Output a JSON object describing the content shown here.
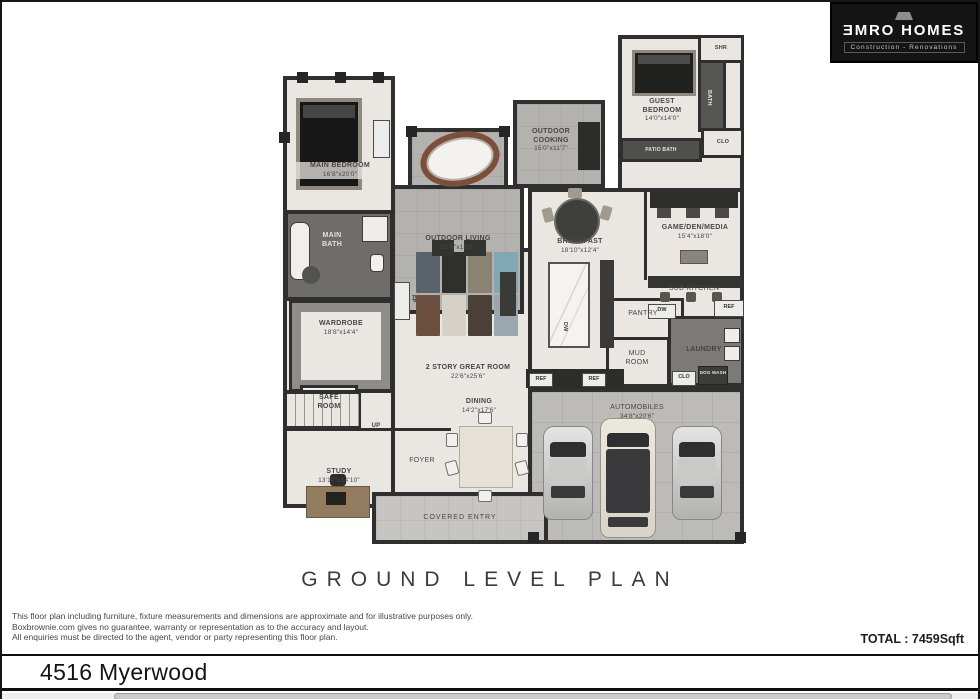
{
  "logo": {
    "brand": "ƎMRO HOMES",
    "tagline": "Construction - Renovations"
  },
  "plan": {
    "title": "GROUND LEVEL PLAN",
    "rooms": [
      {
        "name": "MAIN BEDROOM",
        "dims": "16'8\"x20'0\""
      },
      {
        "name": "OUTDOOR LIVING",
        "dims": "21'6\"x15'0\""
      },
      {
        "name": "OUTDOOR COOKING",
        "dims": "15'0\"x11'7\""
      },
      {
        "name": "GUEST BEDROOM",
        "dims": "14'0\"x14'0\""
      },
      {
        "name": "BREAKFAST",
        "dims": "18'10\"x12'4\""
      },
      {
        "name": "GAME/DEN/MEDIA",
        "dims": "15'4\"x18'0\""
      },
      {
        "name": "MAIN BATH",
        "dims": ""
      },
      {
        "name": "WARDROBE",
        "dims": "18'8\"x14'4\""
      },
      {
        "name": "2 STORY GREAT ROOM",
        "dims": "22'6\"x25'6\""
      },
      {
        "name": "SUB KITCHEN",
        "dims": ""
      },
      {
        "name": "PANTRY",
        "dims": ""
      },
      {
        "name": "MUD ROOM",
        "dims": ""
      },
      {
        "name": "LAUNDRY",
        "dims": ""
      },
      {
        "name": "SAFE ROOM",
        "dims": ""
      },
      {
        "name": "STUDY",
        "dims": "13'10\"x14'10\""
      },
      {
        "name": "FOYER",
        "dims": ""
      },
      {
        "name": "DINING",
        "dims": "14'2\"x17'6\""
      },
      {
        "name": "COVERED ENTRY",
        "dims": ""
      },
      {
        "name": "AUTOMOBILES",
        "dims": "34'8\"x20'6\""
      }
    ],
    "fixtures": {
      "shr": "SHR",
      "bath": "BATH",
      "clo": "CLO",
      "patio_bath": "PATIO BATH",
      "dog_wash": "DOG WASH",
      "dw": "DW",
      "ref": "REF",
      "fp": "FP",
      "up": "UP"
    }
  },
  "footer": {
    "disclaimer": [
      "This floor plan including furniture, fixture measurements and dimensions are approximate and for illustrative purposes only.",
      "Boxbrownie.com gives no guarantee, warranty or representation as to the accuracy and layout.",
      "All enquiries must be directed to the agent, vendor or party representing this floor plan."
    ],
    "total": "TOTAL : 7459Sqft",
    "address": "4516 Myerwood"
  },
  "colors": {
    "wall": "#2f2f2f",
    "indoor_floor": "#eae7e2",
    "outdoor_tile": "#b3b2af",
    "garage_floor": "#bcbbb8",
    "dark_tile": "#6e6d6a",
    "logo_bg": "#141414"
  }
}
